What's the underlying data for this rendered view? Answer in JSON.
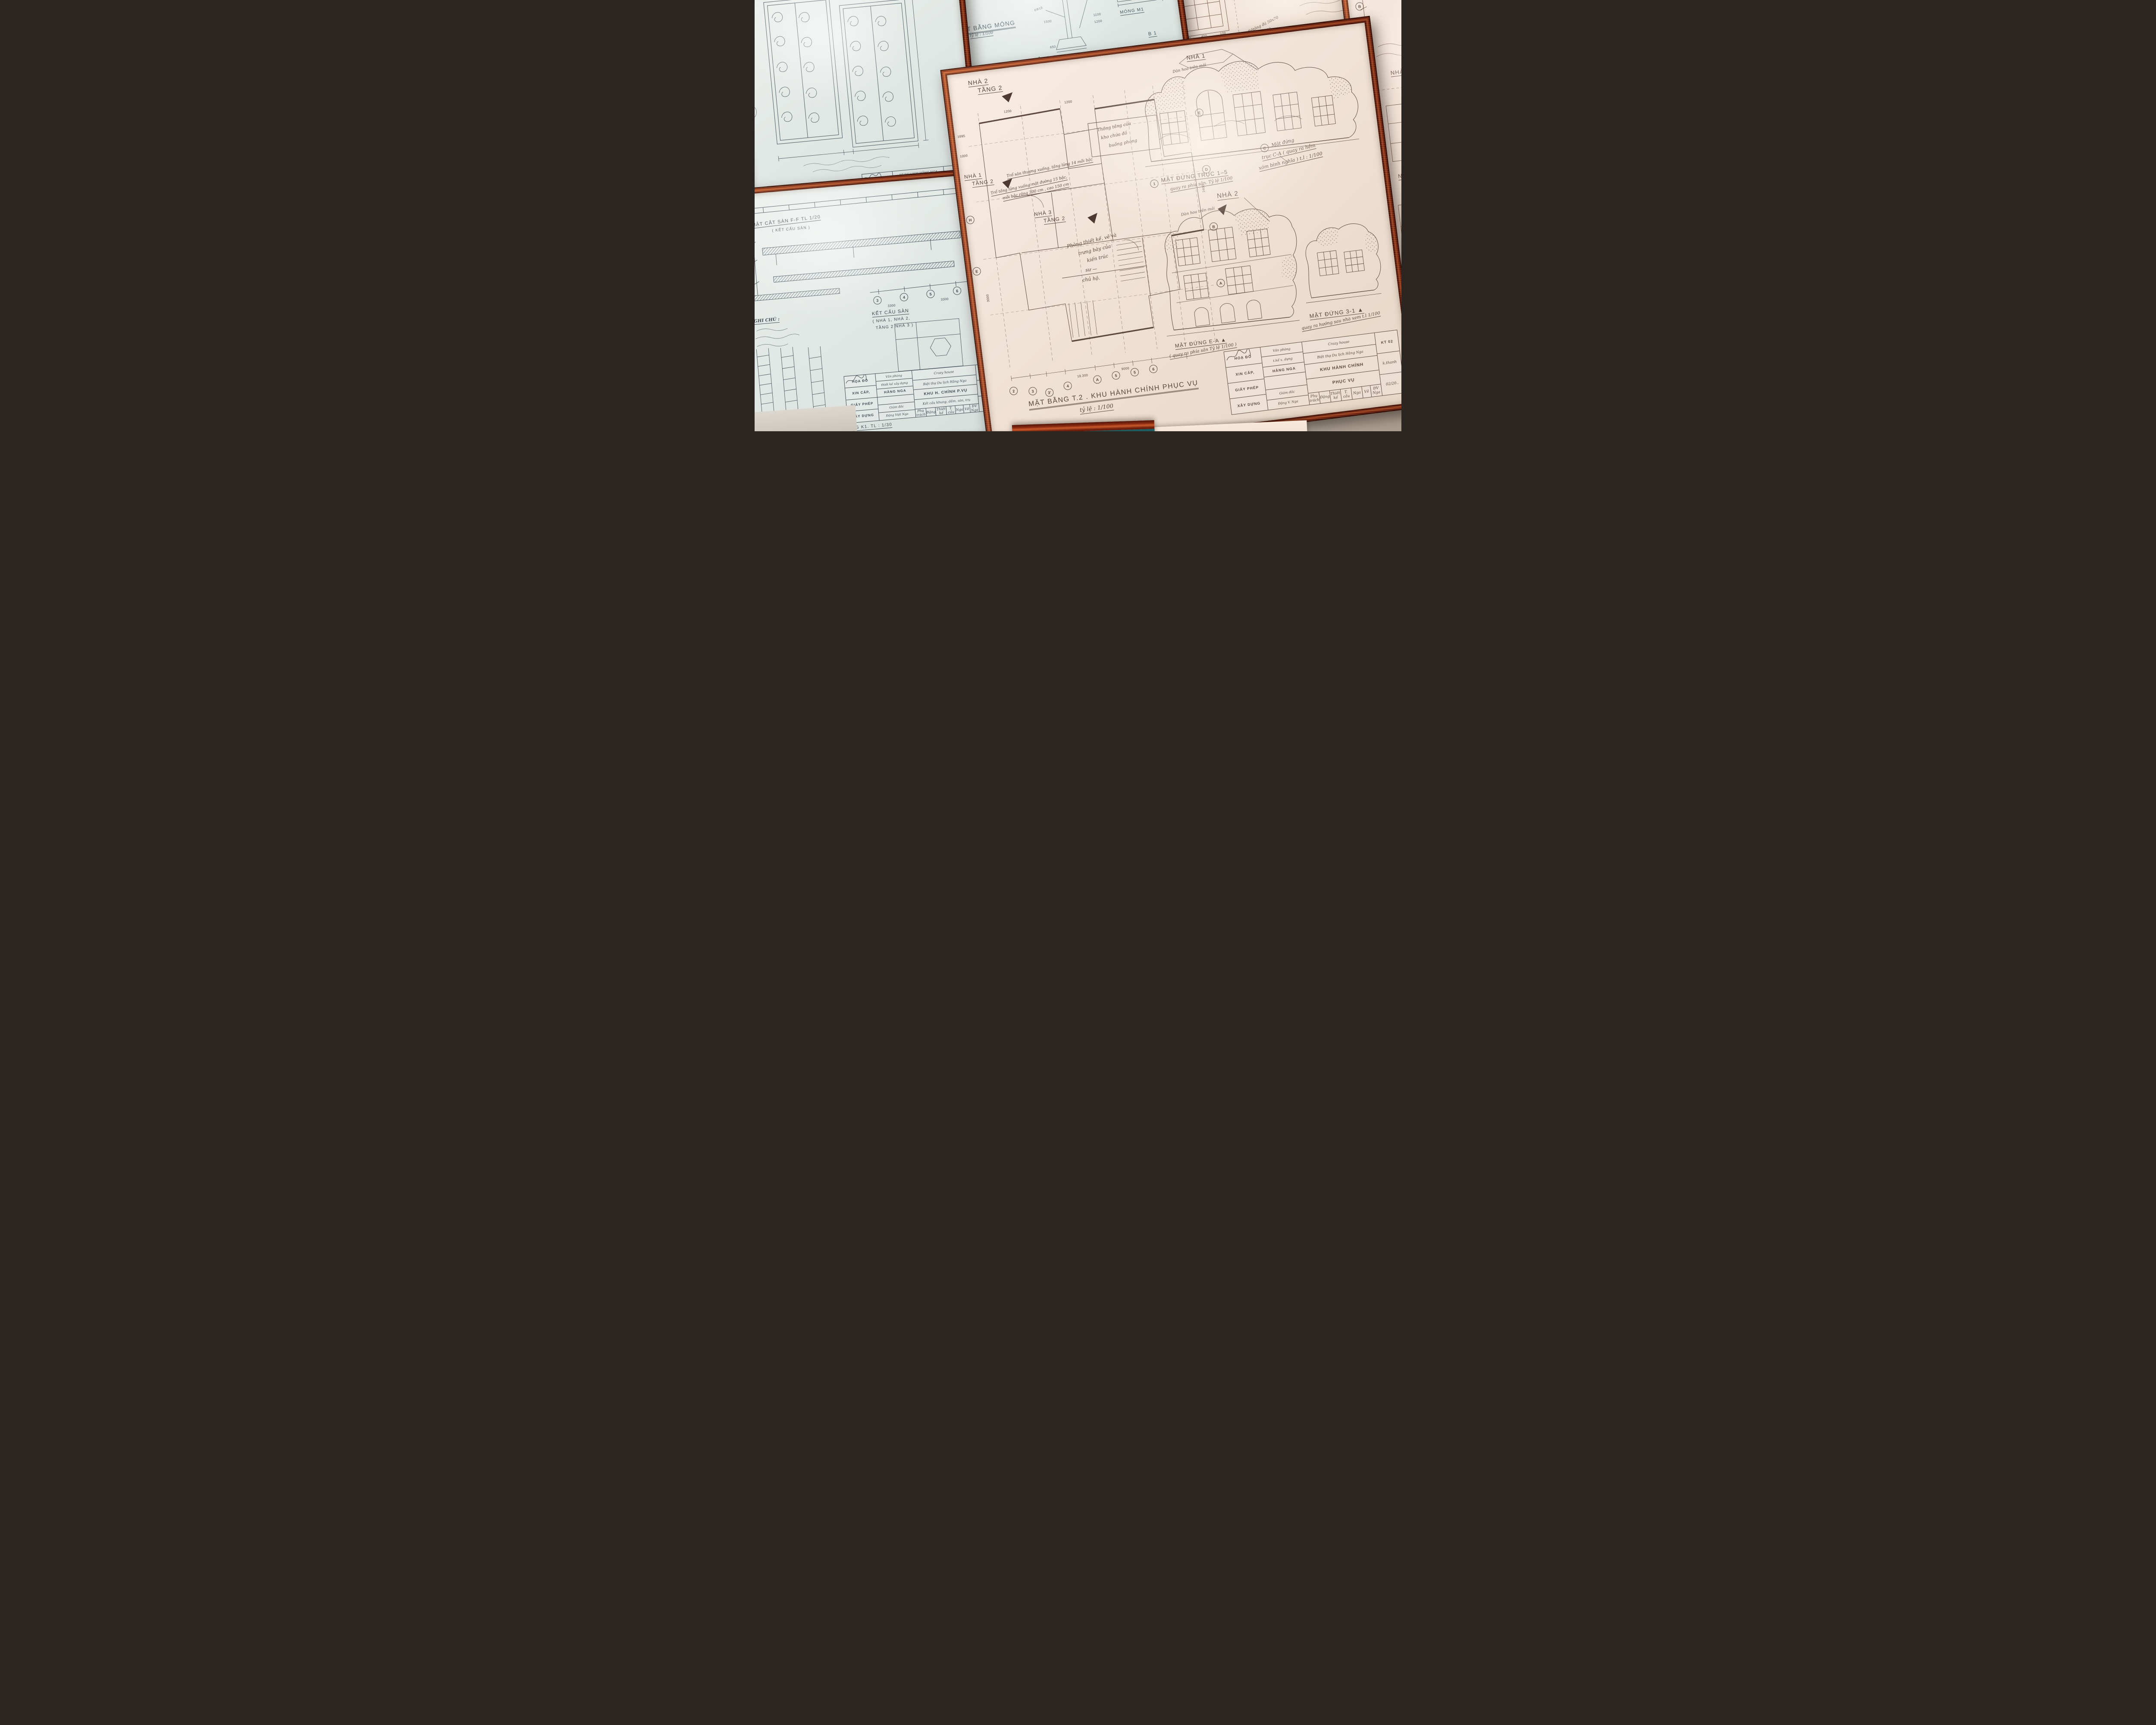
{
  "russian_note": "Уважаемая, мадам Nga !",
  "gate": {
    "tb": {
      "office1": "VP thiết kế",
      "office2": "HẰNG NGA",
      "project1": "BT DU LỊCH HẰNG NGA",
      "project2": "( Crazy House )",
      "item": "NHÀ RÔNG LỚN",
      "detail": "chi tiết hoa sắt",
      "code": "KT 2"
    }
  },
  "foundation": {
    "title": "MẶT BẰNG MÓNG",
    "title_scale": "tỷ lệ : 1/100",
    "cut": "CẮT B-B",
    "cut_scale": "tỷ lệ: 1/20",
    "mong": "MÓNG M1",
    "b1": "B 1",
    "nha2": "NHÀ 2,",
    "rebar": [
      "Φ6 a 100",
      "6Φ18",
      "Φ12 a 150"
    ],
    "dims": [
      "3300",
      "3300",
      "3300",
      "3300",
      "1500",
      "1100",
      "1200",
      "650",
      "1300"
    ],
    "bubbles": [
      "1",
      "2",
      "3",
      "4",
      "5"
    ]
  },
  "notes": {
    "ghichu": "GHI CHÚ :",
    "mong5": "MÓNG M5",
    "mong5_scale": "tỷ lệ 1/20",
    "beton1": "Bêtông đá 50x70",
    "beton2": "vữa M50",
    "dims": [
      "100",
      "400",
      "100"
    ],
    "tb": {
      "c1a": "HOẠ ĐỒ",
      "c1b": "XIN CẤP,",
      "c2a": "Văn phòng",
      "c2b": "t.kế x. dựng",
      "c2c": "HẰNG NGA",
      "c3a": "crazy house",
      "c3b": "Biệt thự Du lịch Hằng Nga",
      "c3c": "KHU H. CHÍNH",
      "c3d": "Mặt bằng"
    }
  },
  "partial": {
    "nha1a": "NHÀ 1",
    "nha1b": "TẦNG 1",
    "nha3a": "NHÀ 3",
    "nha3b": "TẦNG 1",
    "bubbles": [
      "B",
      "C"
    ]
  },
  "main": {
    "nha1_callout": "NHÀ 1",
    "danhoa1": "Dàn hoa trên mái",
    "plan_nha2a": "NHÀ 2",
    "plan_nha2b": "TẦNG 2",
    "plan_nha1a": "NHÀ 1",
    "plan_nha1b": "TẦNG 2",
    "plan_nha3a": "NHÀ 3",
    "plan_nha3b": "TẦNG 2",
    "note_tro1": "Trổ sân thượng xuống, tầng lửng 14 mỗi bậc",
    "note_tro2": "Trổ tầng lửng xuống mặt đường 15 bậc,",
    "note_tro3": "mỗi bậc rộng 300 cm , cao 150 cm",
    "note_thong1": "Thông tầng của",
    "note_thong2": "kho chứa đồ",
    "note_thong3": "buồng phòng",
    "note_phong1": "Phòng thiết kế, vẽ và",
    "note_phong2": "trưng bày của",
    "note_phong3": "kiến trúc",
    "note_phong4": "sư —",
    "note_phong5": "chủ hộ.",
    "elev15_bubble": "1",
    "elev15": "MẶT ĐỨNG TRỤC 1–5",
    "elev15_sub": "quay ra phía sân. Tỷ lệ 1/100",
    "elevCA_bubble": "C",
    "elevCA1": "Mặt đứng",
    "elevCA2": "trục C-A ( quay ra hẻm",
    "elevCA3": "xóm bình nghĩa ) t.l : 1/100",
    "nha2_callout": "NHÀ 2",
    "danhoa2": "Dàn hoa trên mái",
    "elevEA": "MẶT ĐỨNG E-A ▲",
    "elevEA_sub": "( quay ra phía sân Tỷ lệ 1/100 )",
    "elev31": "MẶT ĐỨNG 3-1 ▲",
    "elev31_sub": "quay ra hướng sau nhà xem t.l 1/100",
    "title": "MẶT BẰNG T.2 . KHU HÀNH CHÍNH PHỤC VỤ",
    "title_scale": "tỷ lệ : 1/100",
    "dims": [
      "1895",
      "1000",
      "2400",
      "3000",
      "1200",
      "1200",
      "19.300",
      "9000"
    ],
    "bubbles_bottom": [
      "2",
      "3",
      "3'",
      "4",
      "A",
      "5",
      "5",
      "6"
    ],
    "bubbles_right": [
      "E",
      "D",
      "B",
      "A"
    ],
    "bubbles_left": [
      "H",
      "E"
    ],
    "tb": {
      "c1a": "HOẠ ĐỒ",
      "c1b": "XIN CẤP,",
      "c1c": "GIẤY PHÉP",
      "c1d": "XÂY DỰNG",
      "c2a": "Văn phòng",
      "c2b": "t.kế x. dựng",
      "c2c": "HẰNG NGA",
      "c2d": "Giám đốc",
      "c2e": "Đặng V. Nga",
      "c3a": "Crazy house",
      "c3b": "Biệt thự Du lịch Hằng Nga",
      "c3c": "KHU HÀNH CHÍNH",
      "c3d": "PHỤC VỤ",
      "r1": "Phụ trách",
      "r2": "Đặng",
      "r3": "Thiết kế",
      "r4": "T. cầu",
      "r5": "Nga",
      "r6": "Vẽ",
      "r7": "ĐV Nga",
      "code1": "KT 02",
      "code2": "k.thanh",
      "code3": "02/20.."
    }
  },
  "structure": {
    "cutff1": "MẶT CẮT SÀN F-F TL 1/20",
    "cutff2": "( KẾT CẤU SÀN )",
    "ketcau1": "KẾT CẤU SÀN",
    "ketcau2": "( NHÀ 1, NHÀ 2,",
    "ketcau3": "TẦNG 2 NHÀ 3 )",
    "ghichu": "GHI CHÚ :",
    "khung": "KHUNG K1. TL : 1/30",
    "bubbles": [
      "3",
      "4",
      "5",
      "6"
    ],
    "dims": [
      "3300",
      "3300"
    ],
    "tb": {
      "c1a": "HỌA ĐỒ",
      "c1b": "XIN CẤP,",
      "c1c": "GIẤY PHÉP",
      "c1d": "XÂY DỰNG",
      "c2a": "Văn phòng",
      "c2b": "thiết kế xây dựng",
      "c2c": "HẰNG NGA",
      "c2d": "Giám đốc",
      "c2e": "Đặng Việt Nga",
      "c3a": "Crazy house",
      "c3b": "Biệt thự Du lịch Hằng Nga",
      "c3c": "KHU H. CHÍNH P.VỤ",
      "c3d": "Kết cấu khung, dầm, sàn, trụ",
      "r1": "Phụ trách",
      "r2": "Đặng",
      "r3": "Thiết kế",
      "r4": "T. cầu",
      "r5": "Nga",
      "r6": "Vẽ",
      "r7": "ĐV Nga",
      "code1": "KC:02",
      "code2": "k.thanh",
      "code3": "10/201.."
    }
  }
}
